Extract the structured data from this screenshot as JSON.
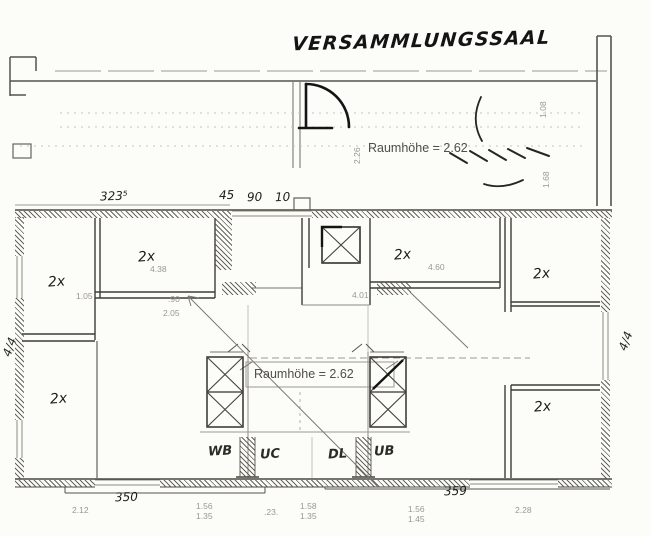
{
  "title": "VERSAMMLUNGSSAAL",
  "upper_hall": {
    "room_height": "Raumhöhe = 2.62",
    "side_dim": "2.26",
    "stair_dim_top": "1.08",
    "stair_dim_bottom": "1.68"
  },
  "top_dims": [
    "323⁵",
    "45",
    "90",
    "10"
  ],
  "rooms": [
    {
      "label": "2x"
    },
    {
      "label": "2x",
      "dim": "4.38"
    },
    {
      "label": "2x"
    },
    {
      "label": "2x",
      "dim": "4.60"
    },
    {
      "label": "2x"
    },
    {
      "label": "2x"
    }
  ],
  "inner_dims": {
    "d105": "1.05",
    "d90": ".90",
    "d205": "2.05",
    "d401": "4.01"
  },
  "center": {
    "room_height": "Raumhöhe = 2.62"
  },
  "corridor_labels": [
    "WB",
    "UC",
    "DL",
    "UB"
  ],
  "bottom_dims": {
    "hand_left": "350",
    "hand_right": "359",
    "p1": "2.12",
    "p2a": "1.56",
    "p2b": "1.35",
    "p3": ".23.",
    "p4a": "1.58",
    "p4b": "1.35",
    "p5a": "1.56",
    "p5b": "1.45",
    "p6": "2.28"
  },
  "side_dims": {
    "left": "4/4",
    "right": "4/4"
  }
}
